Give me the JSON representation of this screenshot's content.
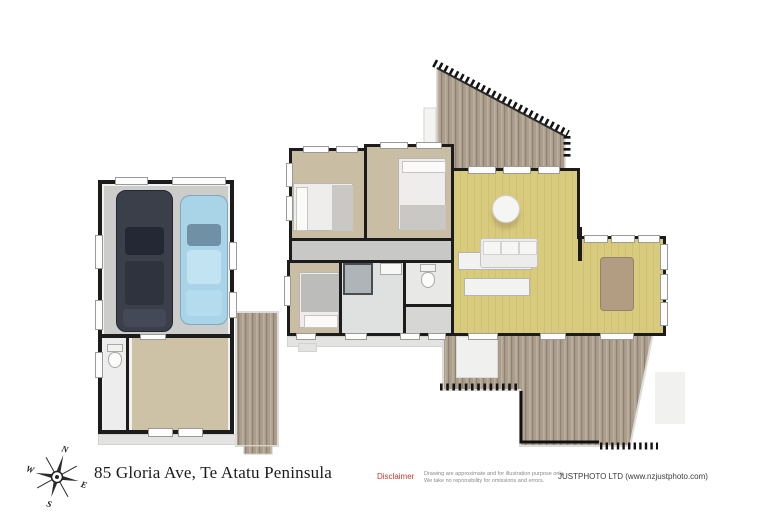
{
  "address": "85 Gloria Ave, Te Atatu Peninsula",
  "footer": {
    "disclaimer_label": "Disclaimer",
    "disclaimer_line1": "Drawing are approximate and for illustration purpose only.",
    "disclaimer_line2": "We take no reponsibility for omissions and errors.",
    "company": "JUSTPHOTO LTD (www.nzjustphoto.com)"
  },
  "compass": {
    "north": "N",
    "south": "S",
    "east": "E",
    "west": "W"
  },
  "colors": {
    "wall": "#1c1c1c",
    "carpet": "#c9bda3",
    "wood_floor": "#d9cb7d",
    "wood_floor_dark": "#d0c170",
    "deck_wood": "#ab9e8c",
    "deck_wood_dark": "#8f8271",
    "deck_wood_light": "#bcb0a0",
    "garage_floor": "#cccccb",
    "disclaimer_red": "#c43a2a",
    "car_dark": "#3a3f4a",
    "car_blue": "#a9d3e6",
    "dining_table": "#b29c82"
  }
}
